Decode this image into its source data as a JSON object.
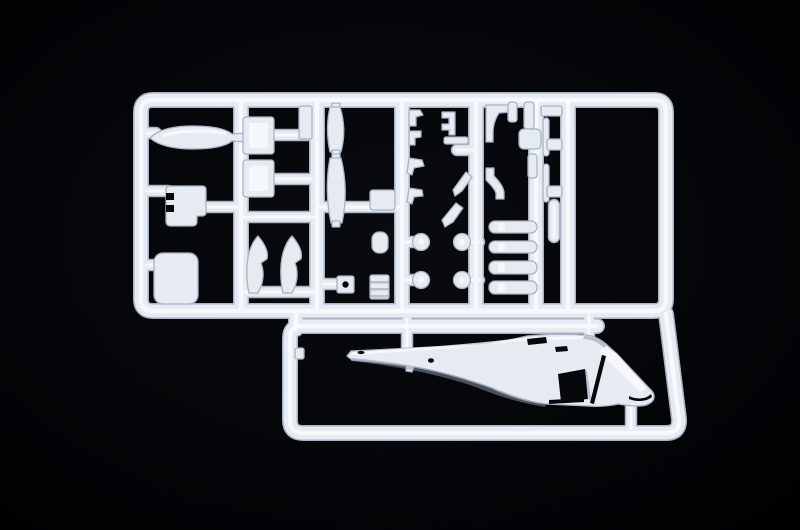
{
  "scene": {
    "type": "photograph",
    "subject": "White injection-molded plastic model kit sprue (parts tree) with helicopter components",
    "background": "black studio backdrop",
    "notable_feature": "right half of a light helicopter fuselage molded inside the lower frame bay"
  },
  "colors": {
    "background_center": "#0a0b0f",
    "background_edge": "#000103",
    "plastic_base": "#e6eaf1",
    "plastic_highlight": "#fafbfe",
    "plastic_edge": "#aab3c2",
    "plastic_shading": "#8e97a8",
    "cutout": "#06080c"
  },
  "sprue": {
    "frame_sections": [
      "upper parts grid (six vertical rails)",
      "lower fuselage bay"
    ],
    "parts": [
      {
        "name": "tank-fairing",
        "location": "upper-left column"
      },
      {
        "name": "instrument-panel",
        "location": "upper-left column, notched plate"
      },
      {
        "name": "floor-panel",
        "location": "lower-left column, rounded square"
      },
      {
        "name": "door-upper",
        "location": "second column"
      },
      {
        "name": "door-lower",
        "location": "second column"
      },
      {
        "name": "seat-frame-left",
        "location": "second column, curved blade"
      },
      {
        "name": "seat-frame-right",
        "location": "second column, curved blade"
      },
      {
        "name": "side-plate",
        "location": "third rail, small rectangle"
      },
      {
        "name": "blister-window-upper",
        "location": "third column, bulged lens"
      },
      {
        "name": "blister-window-lower",
        "location": "third column, bulged lens"
      },
      {
        "name": "plate-with-hole",
        "location": "third column bottom"
      },
      {
        "name": "gear-block",
        "location": "center column"
      },
      {
        "name": "small-cylinder",
        "location": "center column"
      },
      {
        "name": "ribbed-stack",
        "location": "center column bottom"
      },
      {
        "name": "antenna-hooks",
        "location": "fourth rail, four small brackets"
      },
      {
        "name": "step-bracket",
        "location": "between fourth and fifth rails"
      },
      {
        "name": "chevron-linkages",
        "location": "between fourth and fifth rails"
      },
      {
        "name": "bent-exhaust-rods",
        "location": "fifth rail"
      },
      {
        "name": "rotor-hub-discs",
        "location": "four round discs on stems"
      },
      {
        "name": "skid-tubes",
        "location": "four horizontal bars, right of center"
      },
      {
        "name": "ladder-rods",
        "location": "thin rods between right rails"
      },
      {
        "name": "helicopter-fuselage-half",
        "location": "lower bay, nose pointing right"
      }
    ]
  }
}
